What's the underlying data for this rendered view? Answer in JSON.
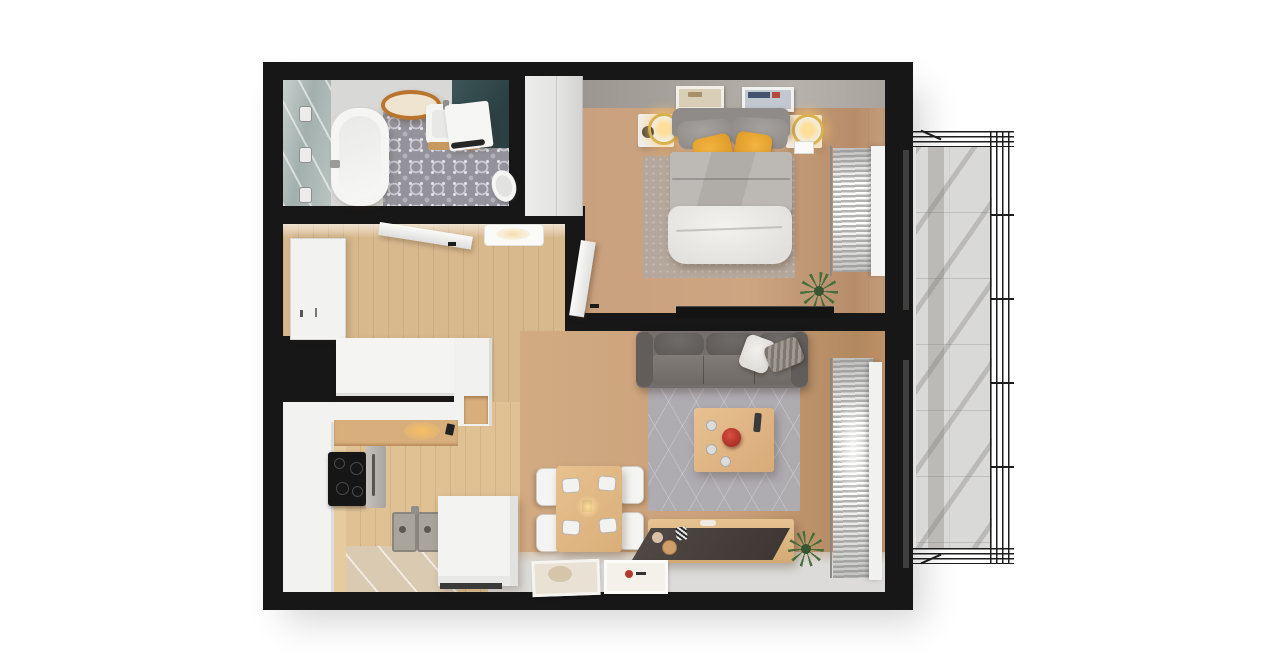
{
  "scene": {
    "type": "3d-rendered-apartment-floor-plan-top-view",
    "background_color": "#ffffff",
    "wall_color": "#171717",
    "no_visible_text": true
  },
  "palette": {
    "wood_floor": "#c9a078",
    "kitchen_floor": "#e0c194",
    "bathroom_tile": "#94939b",
    "teal_accent_wall": "#32474a",
    "sofa_gray": "#6e6a67",
    "blanket_gray": "#b9b5b1",
    "duvet_white": "#ebe9e6",
    "pillow_yellow": "#eaa62c",
    "rug_living": "#aeabb1",
    "rug_bedroom": "#b4a79b",
    "furniture_wood": "#ddb481",
    "lamp_glow": "#f6dfae",
    "plant_green": "#406c3a",
    "balcony_concrete": "#d9d9d7",
    "railing": "#1d1d1d"
  },
  "rooms": {
    "bathroom": {
      "objects": [
        "shower-glass-wall",
        "three-chrome-handles",
        "bathtub",
        "oval-wood-mirror",
        "sink-vanity",
        "washing-machine",
        "teal-accent-wall",
        "toilet",
        "ornamental-tile-floor"
      ]
    },
    "hallway": {
      "objects": [
        "entry-door",
        "open-bathroom-door",
        "ceiling-light",
        "white-wardrobe"
      ]
    },
    "bedroom": {
      "objects": [
        "double-bed",
        "gray-headboard",
        "two-yellow-pillows",
        "white-duvet",
        "two-nightstands",
        "two-ring-lamps",
        "two-wall-pictures",
        "area-rug",
        "wardrobe",
        "tv-on-wall",
        "potted-plant",
        "curtains",
        "open-door"
      ]
    },
    "kitchen": {
      "objects": [
        "u-shaped-white-counter",
        "wood-countertop",
        "black-cooktop",
        "oven",
        "double-sink",
        "peninsula-cabinet",
        "under-cabinet-light"
      ]
    },
    "living_room": {
      "objects": [
        "gray-sofa",
        "two-throw-pillows",
        "hexagon-pattern-rug",
        "coffee-table",
        "red-bowl",
        "dining-table",
        "four-chairs",
        "four-place-settings",
        "pendant-light-glow",
        "tv-sideboard",
        "potted-plant",
        "curtains",
        "two-doormats"
      ]
    },
    "balcony": {
      "objects": [
        "wireframe-railing",
        "concrete-tile-floor",
        "railing-shadows"
      ]
    }
  }
}
